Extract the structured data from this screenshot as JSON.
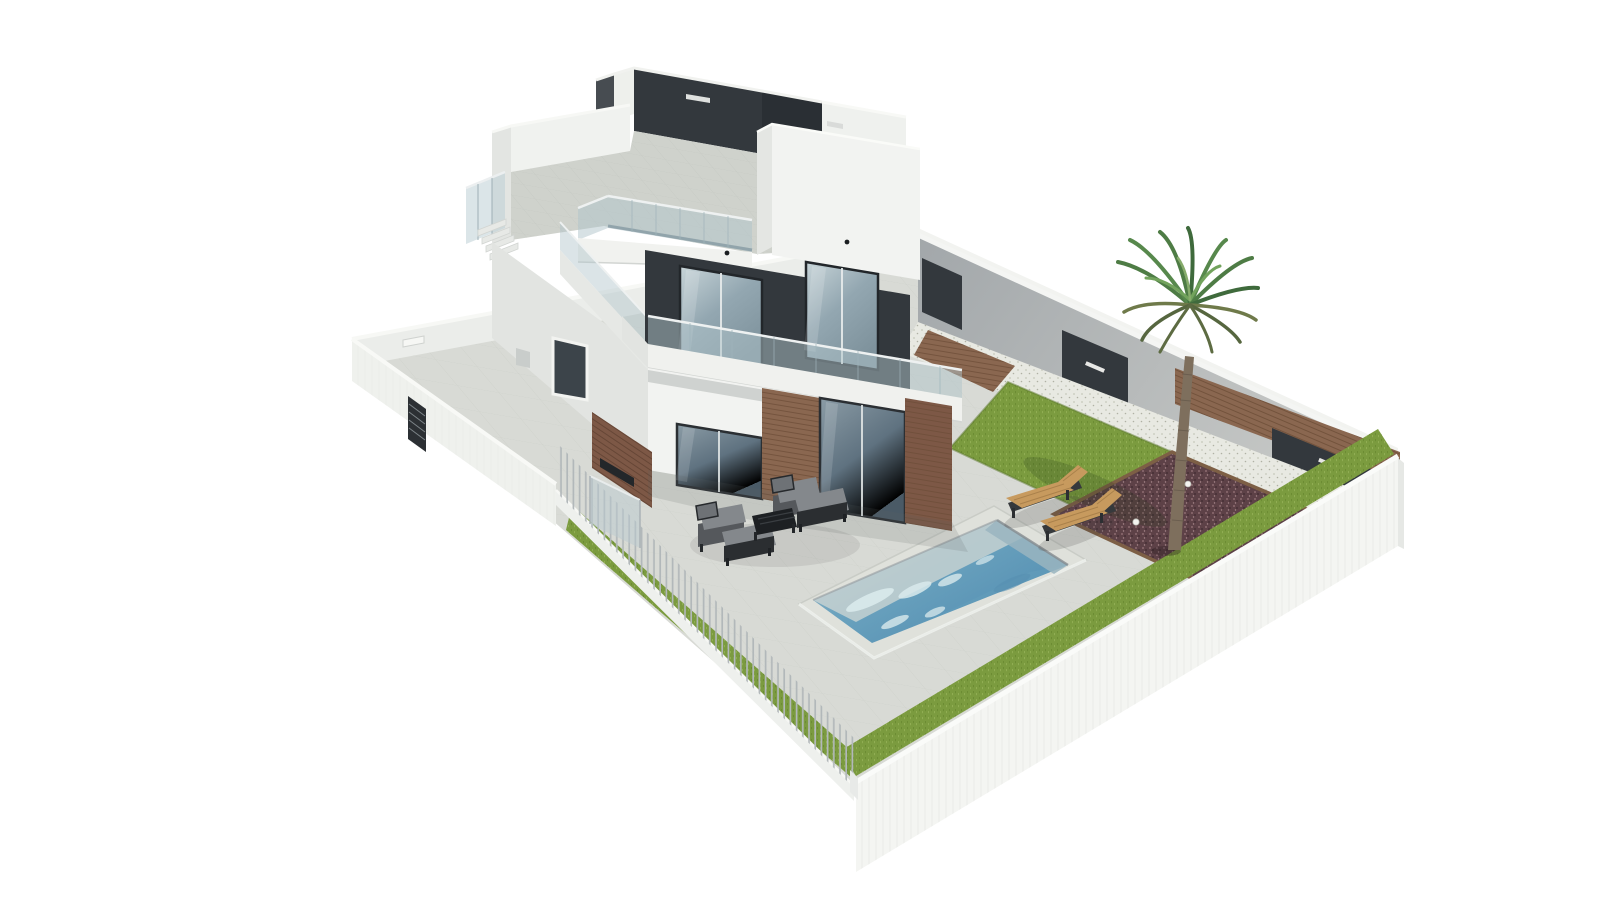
{
  "meta": {
    "title": "3D architectural render — modern two-storey white villa with roof terrace, pool and garden",
    "type": "architectural-visualization",
    "background": "#ffffff"
  },
  "palette": {
    "wall_white": "#f2f3f1",
    "wall_light_gray": "#e2e4e1",
    "boundary_gray": "#a9aeb0",
    "charcoal": "#33383d",
    "charcoal_light": "#474c51",
    "glass_frame": "#23272b",
    "wood": "#8a6750",
    "brick": "#7d5846",
    "pavement": "#d8dad5",
    "terrace_tile": "#cfd2cc",
    "lawn": "#7b9b3f",
    "gravel": "#e8e9e2",
    "mulch": "#5d4147",
    "pool_deep": "#659fbc",
    "pool_shallow": "#c6d1d1",
    "pool_ripple": "#d9eaec",
    "lounger_wood": "#c79a5e",
    "cushion_gray": "#84888c",
    "furniture_frame": "#27292c",
    "fence_slat": "#b2b8ba",
    "palm_green": "#4e7c45",
    "palm_trunk": "#7e6f5d"
  },
  "scene": {
    "description": "Bird's-eye 3D visualization of a detached modern villa plot: white perimeter walls, slatted front fence, paved yard, rectangular swimming pool, two timber sun loungers, dark-gray outdoor lounge set, central lawn, mulch bed with a single palm tree, and a white two-storey house with charcoal accents, wood cladding, glass balustrades and a roof terrace.",
    "elements": [
      {
        "id": "villa-house",
        "label": "Two-storey villa with roof terrace"
      },
      {
        "id": "roof-terrace",
        "label": "Roof terrace with glass balustrade and dark parapet"
      },
      {
        "id": "balcony",
        "label": "First-floor balcony with glass balustrade"
      },
      {
        "id": "sliding-doors",
        "label": "Ground-floor glass sliding doors",
        "count": 2
      },
      {
        "id": "upper-windows",
        "label": "First-floor picture windows",
        "count": 2
      },
      {
        "id": "swimming-pool",
        "label": "Rectangular swimming pool"
      },
      {
        "id": "sun-loungers",
        "label": "Timber sun loungers",
        "count": 2
      },
      {
        "id": "outdoor-lounge-set",
        "label": "Outdoor lounge set (2 armchairs, 2 ottomans, coffee table)"
      },
      {
        "id": "palm-tree",
        "label": "Palm tree in mulch bed"
      },
      {
        "id": "lawn-areas",
        "label": "Artificial lawn areas",
        "count": 3
      },
      {
        "id": "perimeter-wall",
        "label": "White perimeter walls with dark service panels"
      },
      {
        "id": "slat-fence",
        "label": "Thin metal slat fence on street side"
      },
      {
        "id": "garden-gate",
        "label": "Dark slatted pedestrian gate"
      },
      {
        "id": "garden-spotlights",
        "label": "Round ground spotlights",
        "count": 2
      }
    ]
  }
}
